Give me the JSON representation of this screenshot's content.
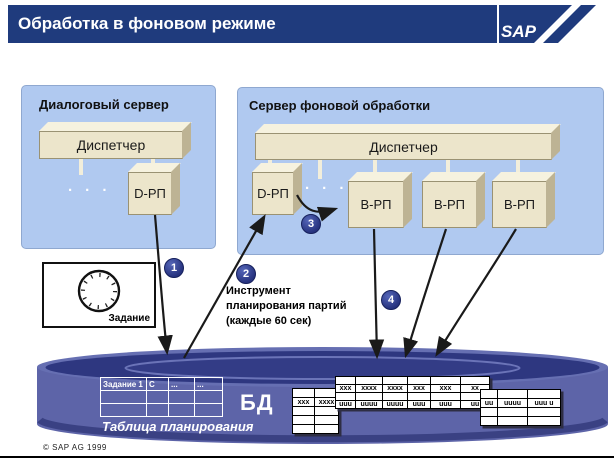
{
  "header": {
    "title": "Обработка в фоновом режиме",
    "logo_text": "SAP"
  },
  "panels": {
    "dialog": {
      "title": "Диалоговый сервер",
      "dispatcher": "Диспетчер",
      "dots": "· · ·",
      "work_process": "D-РП"
    },
    "background": {
      "title": "Сервер фоновой обработки",
      "dispatcher": "Диспетчер",
      "dots": "· · ·",
      "dialog_wp": "D-РП",
      "bg_wps": [
        "В-РП",
        "В-РП",
        "В-РП"
      ]
    }
  },
  "steps": {
    "s1": "1",
    "s2": "2",
    "s3": "3",
    "s4": "4"
  },
  "job_box": {
    "label": "Задание"
  },
  "scheduler_note": "Инструмент\nпланирования партий\n(каждые 60 сек)",
  "database": {
    "label": "БД",
    "schedule_caption": "Таблица планирования",
    "schedule_grid": [
      [
        "Задание 1",
        "С",
        "...",
        "..."
      ],
      [
        "",
        "",
        "",
        ""
      ],
      [
        "",
        "",
        "",
        ""
      ]
    ],
    "table_a": [
      [
        "",
        ""
      ],
      [
        "xxx",
        "xxxx"
      ],
      [
        "",
        ""
      ],
      [
        "",
        ""
      ],
      [
        "",
        ""
      ]
    ],
    "table_b": [
      [
        "",
        "",
        "",
        "",
        "",
        ""
      ],
      [
        "xxx",
        "xxxx",
        "xxxx",
        "xxx",
        "xxx",
        "xx"
      ],
      [
        "",
        "",
        "",
        "",
        "",
        ""
      ],
      [
        "uuu",
        "uuuu",
        "uuuu",
        "uuu",
        "uuu",
        "uu"
      ]
    ],
    "table_c": [
      [
        "",
        "",
        ""
      ],
      [
        "uu",
        "uuuu",
        "uuu u"
      ],
      [
        "",
        "",
        ""
      ],
      [
        "",
        "",
        ""
      ]
    ]
  },
  "footer": {
    "copyright": "© SAP AG 1999"
  },
  "colors": {
    "header_navy": "#1f3b7d",
    "panel_blue": "#b0c9f0",
    "box_beige": "#ece5cb",
    "cylinder_body": "#5d64a8",
    "cylinder_top": "#2e3780",
    "badge_navy": "#26327e"
  }
}
